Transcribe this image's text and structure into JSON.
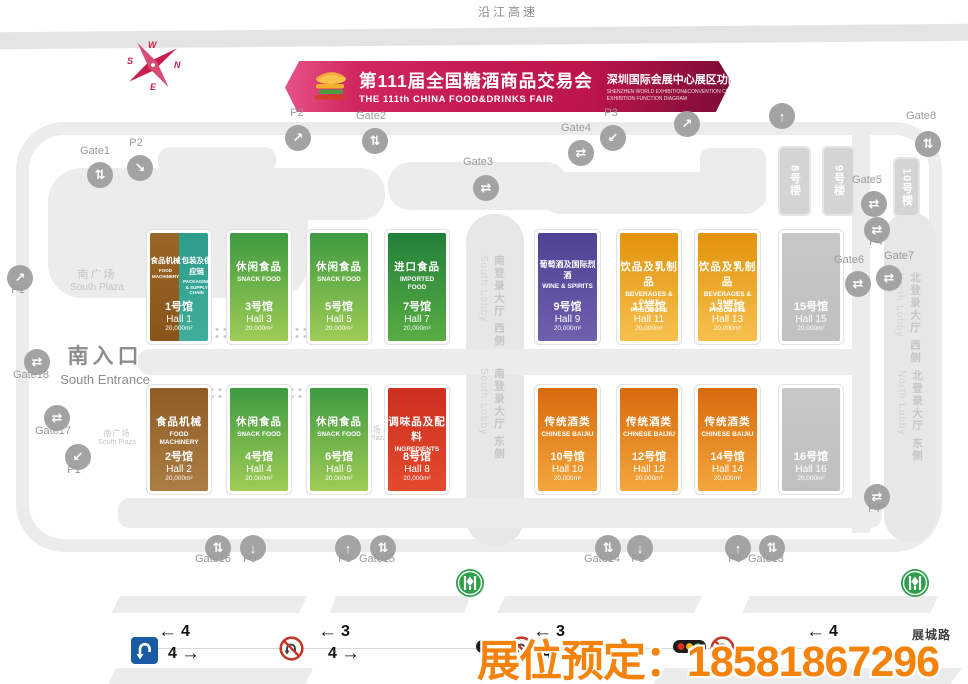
{
  "roads": {
    "top": "沿江高速",
    "bottom": "展城路"
  },
  "hotline": {
    "text": "展位预定：18581867296",
    "color": "#f5820a"
  },
  "banner": {
    "title_cn": "第111届全国糖酒商品交易会",
    "title_en": "THE 111th CHINA FOOD&DRINKS FAIR",
    "subtitle_cn": "深圳国际会展中心展区功能图",
    "subtitle_en1": "SHENZHEN WORLD EXHIBITION&CONVENTION CENTER",
    "subtitle_en2": "EXHIBITION FUNCTION DIAGRAM",
    "accent_color": "#c41c52"
  },
  "compass": {
    "letters": [
      "W",
      "N",
      "S",
      "E"
    ]
  },
  "plaza": {
    "cn": "南广场",
    "en": "South Plaza"
  },
  "entrance": {
    "cn": "南入口",
    "en": "South Entrance"
  },
  "lobbies": [
    {
      "cn": "南登录大厅 西侧",
      "en": "South Lobby",
      "x": 478,
      "y": 255
    },
    {
      "cn": "南登录大厅 东侧",
      "en": "South Lobby",
      "x": 478,
      "y": 368
    },
    {
      "cn": "北登录大厅 西侧",
      "en": "North Lobby",
      "x": 894,
      "y": 272
    },
    {
      "cn": "北登录大厅 东侧",
      "en": "North Lobby",
      "x": 896,
      "y": 370
    }
  ],
  "buildings": [
    {
      "label": "8号楼",
      "x": 778,
      "y": 146,
      "w": 33,
      "h": 70
    },
    {
      "label": "9号楼",
      "x": 822,
      "y": 146,
      "w": 33,
      "h": 70
    },
    {
      "label": "10号楼",
      "x": 893,
      "y": 157,
      "w": 27,
      "h": 60
    }
  ],
  "halls": [
    {
      "x": 150,
      "y": 233,
      "w": 58,
      "h": 108,
      "number_cn": "1号馆",
      "hall_en": "Hall 1",
      "area": "20,000m²",
      "sections": [
        {
          "cn": "食品机械",
          "en": "FOOD MACHINERY",
          "grad": [
            "#9a6728",
            "#8a5418"
          ]
        },
        {
          "cn": "包装及供应链",
          "en": "PACKAGING & SUPPLY CHAIN",
          "grad": [
            "#2d9c8c",
            "#3fae9a"
          ]
        }
      ]
    },
    {
      "x": 230,
      "y": 233,
      "w": 58,
      "h": 108,
      "number_cn": "3号馆",
      "hall_en": "Hall 3",
      "area": "20,000m²",
      "sections": [
        {
          "cn": "休闲食品",
          "en": "SNACK FOOD",
          "grad": [
            "#3e9a41",
            "#9fcc55"
          ]
        }
      ]
    },
    {
      "x": 310,
      "y": 233,
      "w": 58,
      "h": 108,
      "number_cn": "5号馆",
      "hall_en": "Hall 5",
      "area": "20,000m²",
      "sections": [
        {
          "cn": "休闲食品",
          "en": "SNACK FOOD",
          "grad": [
            "#3e9a41",
            "#9fcc55"
          ]
        }
      ]
    },
    {
      "x": 388,
      "y": 233,
      "w": 58,
      "h": 108,
      "number_cn": "7号馆",
      "hall_en": "Hall 7",
      "area": "20,000m²",
      "sections": [
        {
          "cn": "进口食品",
          "en": "IMPORTED FOOD",
          "grad": [
            "#21803a",
            "#5aad44"
          ]
        }
      ]
    },
    {
      "x": 538,
      "y": 233,
      "w": 59,
      "h": 108,
      "number_cn": "9号馆",
      "hall_en": "Hall 9",
      "area": "20,000m²",
      "sections": [
        {
          "cn": "葡萄酒及国际烈酒",
          "en": "WINE & SPIRITS",
          "grad": [
            "#4d4295",
            "#6f60ad"
          ]
        }
      ]
    },
    {
      "x": 620,
      "y": 233,
      "w": 58,
      "h": 108,
      "number_cn": "11号馆",
      "hall_en": "Hall 11",
      "area": "20,000m²",
      "sections": [
        {
          "cn": "饮品及乳制品",
          "en": "BEVERAGES & DAIRT PRODUCTS",
          "grad": [
            "#e2930d",
            "#f6c04e"
          ]
        }
      ]
    },
    {
      "x": 698,
      "y": 233,
      "w": 59,
      "h": 108,
      "number_cn": "13号馆",
      "hall_en": "Hall 13",
      "area": "20,000m²",
      "sections": [
        {
          "cn": "饮品及乳制品",
          "en": "BEVERAGES & DAIRT PRODUCTS",
          "grad": [
            "#e2930d",
            "#f6c04e"
          ]
        }
      ]
    },
    {
      "x": 782,
      "y": 233,
      "w": 58,
      "h": 108,
      "number_cn": "15号馆",
      "hall_en": "Hall 15",
      "area": "20,000m²",
      "sections": [
        {
          "cn": "",
          "en": "",
          "grad": [
            "#c7c7c7",
            "#c0c0c0"
          ]
        }
      ]
    },
    {
      "x": 150,
      "y": 388,
      "w": 58,
      "h": 103,
      "number_cn": "2号馆",
      "hall_en": "Hall 2",
      "area": "20,000m²",
      "sections": [
        {
          "cn": "食品机械",
          "en": "FOOD MACHINERY",
          "grad": [
            "#8f5c24",
            "#ab7e46"
          ]
        }
      ]
    },
    {
      "x": 230,
      "y": 388,
      "w": 58,
      "h": 103,
      "number_cn": "4号馆",
      "hall_en": "Hall 4",
      "area": "20,000m²",
      "sections": [
        {
          "cn": "休闲食品",
          "en": "SNACK FOOD",
          "grad": [
            "#3e9a41",
            "#9fcc55"
          ]
        }
      ]
    },
    {
      "x": 310,
      "y": 388,
      "w": 58,
      "h": 103,
      "number_cn": "6号馆",
      "hall_en": "Hall 6",
      "area": "20,000m²",
      "sections": [
        {
          "cn": "休闲食品",
          "en": "SNACK FOOD",
          "grad": [
            "#3e9a41",
            "#9fcc55"
          ]
        }
      ]
    },
    {
      "x": 388,
      "y": 388,
      "w": 58,
      "h": 103,
      "number_cn": "8号馆",
      "hall_en": "Hall 8",
      "area": "20,000m²",
      "sections": [
        {
          "cn": "调味品及配料",
          "en": "INGREDIENTS",
          "grad": [
            "#cc2f1f",
            "#e44a2d"
          ]
        }
      ]
    },
    {
      "x": 538,
      "y": 388,
      "w": 59,
      "h": 103,
      "number_cn": "10号馆",
      "hall_en": "Hall 10",
      "area": "20,000m²",
      "sections": [
        {
          "cn": "传统酒类",
          "en": "CHINESE BAIJIU",
          "grad": [
            "#d86a0d",
            "#f3a73c"
          ]
        }
      ]
    },
    {
      "x": 620,
      "y": 388,
      "w": 58,
      "h": 103,
      "number_cn": "12号馆",
      "hall_en": "Hall 12",
      "area": "20,000m²",
      "sections": [
        {
          "cn": "传统酒类",
          "en": "CHINESE BAIJIU",
          "grad": [
            "#d86a0d",
            "#f3a73c"
          ]
        }
      ]
    },
    {
      "x": 698,
      "y": 388,
      "w": 59,
      "h": 103,
      "number_cn": "14号馆",
      "hall_en": "Hall 14",
      "area": "20,000m²",
      "sections": [
        {
          "cn": "传统酒类",
          "en": "CHINESE BAIJIU",
          "grad": [
            "#d86a0d",
            "#f3a73c"
          ]
        }
      ]
    },
    {
      "x": 782,
      "y": 388,
      "w": 58,
      "h": 103,
      "number_cn": "16号馆",
      "hall_en": "Hall 16",
      "area": "20,000m²",
      "sections": [
        {
          "cn": "",
          "en": "",
          "grad": [
            "#c7c7c7",
            "#c0c0c0"
          ]
        }
      ]
    }
  ],
  "markers": [
    {
      "label": "Gate1",
      "x": 100,
      "y": 175,
      "glyph": "⇅",
      "lx": 95,
      "ly": 152
    },
    {
      "label": "P2",
      "x": 140,
      "y": 168,
      "glyph": "↘",
      "lx": 136,
      "ly": 144
    },
    {
      "label": "P1",
      "x": 20,
      "y": 278,
      "glyph": "↗",
      "lx": 18,
      "ly": 291
    },
    {
      "label": "Gate18",
      "x": 37,
      "y": 362,
      "glyph": "⇄",
      "lx": 31,
      "ly": 376
    },
    {
      "label": "Gate17",
      "x": 57,
      "y": 418,
      "glyph": "⇄",
      "lx": 53,
      "ly": 432
    },
    {
      "label": "P1",
      "x": 78,
      "y": 457,
      "glyph": "↙",
      "lx": 74,
      "ly": 471
    },
    {
      "label": "P2",
      "x": 298,
      "y": 138,
      "glyph": "↗",
      "lx": 297,
      "ly": 114
    },
    {
      "label": "Gate2",
      "x": 375,
      "y": 141,
      "glyph": "⇅",
      "lx": 371,
      "ly": 117
    },
    {
      "label": "Gate3",
      "x": 486,
      "y": 188,
      "glyph": "⇄",
      "lx": 478,
      "ly": 163
    },
    {
      "label": "Gate4",
      "x": 581,
      "y": 153,
      "glyph": "⇄",
      "lx": 576,
      "ly": 129
    },
    {
      "label": "P3",
      "x": 613,
      "y": 138,
      "glyph": "↙",
      "lx": 611,
      "ly": 114
    },
    {
      "label": "",
      "x": 687,
      "y": 124,
      "glyph": "↗"
    },
    {
      "label": "",
      "x": 782,
      "y": 116,
      "glyph": "↑"
    },
    {
      "label": "Gate8",
      "x": 928,
      "y": 144,
      "glyph": "⇅",
      "lx": 921,
      "ly": 117
    },
    {
      "label": "Gate5",
      "x": 874,
      "y": 204,
      "glyph": "⇄",
      "lx": 867,
      "ly": 181
    },
    {
      "label": "P4",
      "x": 877,
      "y": 230,
      "glyph": "⇄",
      "lx": 876,
      "ly": 243
    },
    {
      "label": "Gate6",
      "x": 858,
      "y": 284,
      "glyph": "⇄",
      "lx": 849,
      "ly": 261
    },
    {
      "label": "Gate7",
      "x": 889,
      "y": 278,
      "glyph": "⇄",
      "lx": 899,
      "ly": 257
    },
    {
      "label": "P7",
      "x": 877,
      "y": 497,
      "glyph": "⇄",
      "lx": 875,
      "ly": 510
    },
    {
      "label": "Gate16",
      "x": 218,
      "y": 548,
      "glyph": "⇅",
      "lx": 213,
      "ly": 560
    },
    {
      "label": "P9",
      "x": 253,
      "y": 548,
      "glyph": "↓",
      "lx": 250,
      "ly": 560
    },
    {
      "label": "P9",
      "x": 348,
      "y": 548,
      "glyph": "↑",
      "lx": 345,
      "ly": 560
    },
    {
      "label": "Gate15",
      "x": 383,
      "y": 548,
      "glyph": "⇅",
      "lx": 377,
      "ly": 560
    },
    {
      "label": "Gate14",
      "x": 608,
      "y": 548,
      "glyph": "⇅",
      "lx": 602,
      "ly": 560
    },
    {
      "label": "P8",
      "x": 640,
      "y": 548,
      "glyph": "↓",
      "lx": 638,
      "ly": 560
    },
    {
      "label": "P8",
      "x": 738,
      "y": 548,
      "glyph": "↑",
      "lx": 735,
      "ly": 560
    },
    {
      "label": "Gate13",
      "x": 772,
      "y": 548,
      "glyph": "⇅",
      "lx": 766,
      "ly": 560
    }
  ],
  "lanes": [
    {
      "x": 158,
      "left": "4",
      "right": "4"
    },
    {
      "x": 318,
      "left": "3",
      "right": "4"
    },
    {
      "x": 533,
      "left": "3",
      "right": "4"
    },
    {
      "x": 806,
      "left": "4",
      "right": "4"
    }
  ],
  "metro_stations": [
    {
      "x": 455,
      "y": 568
    },
    {
      "x": 900,
      "y": 568
    }
  ]
}
